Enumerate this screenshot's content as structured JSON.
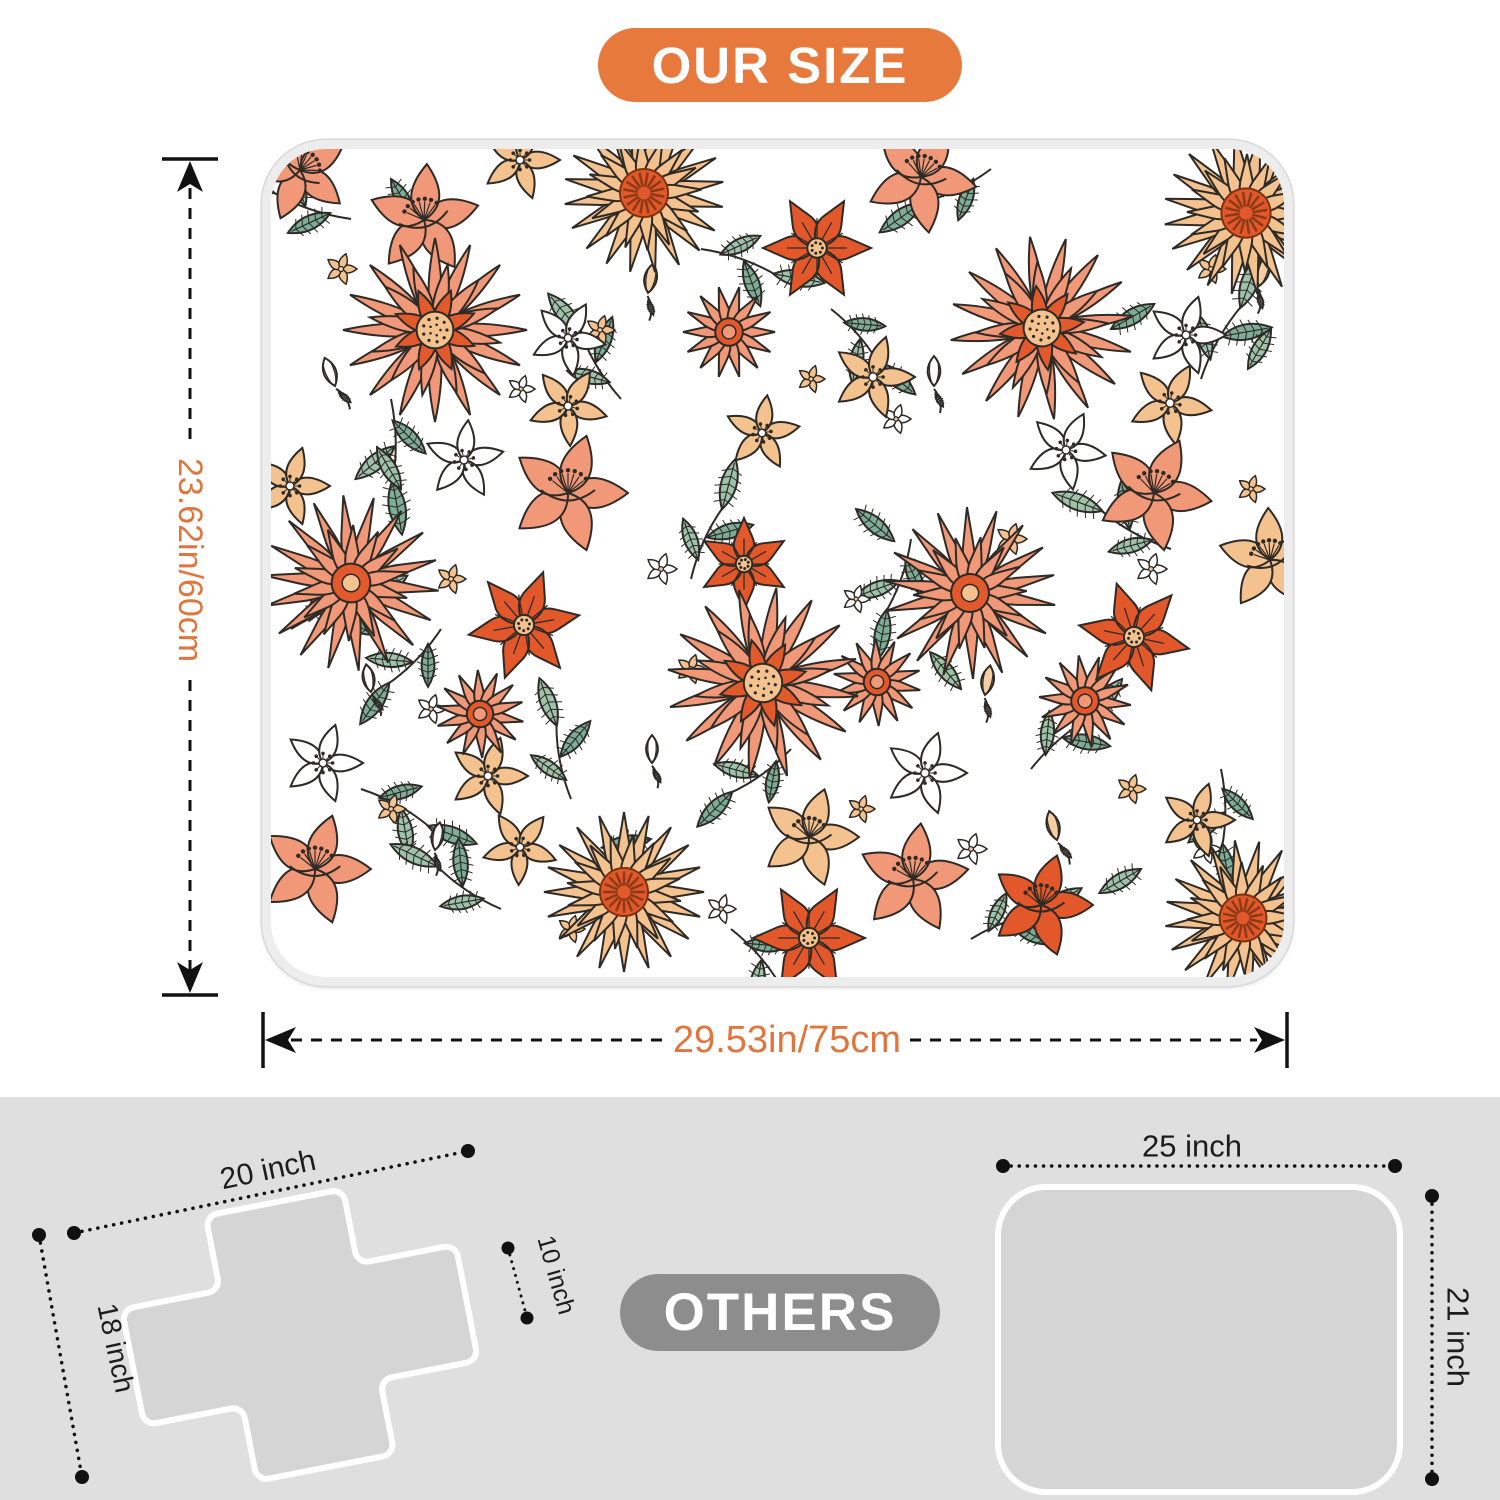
{
  "header": {
    "badge": "OUR SIZE"
  },
  "product_mat": {
    "height_label": "23.62in/60cm",
    "width_label": "29.53in/75cm"
  },
  "others": {
    "badge": "OTHERS",
    "cross_mat": {
      "width_label": "20 inch",
      "side_label": "18 inch",
      "arm_label": "10 inch"
    },
    "rect_mat": {
      "width_label": "25 inch",
      "height_label": "21 inch"
    }
  },
  "colors": {
    "accent": "#E8793C",
    "dim_text": "#DF763E",
    "badge_gray": "#8D8D8D",
    "section_bg": "#DFDFDF",
    "mat_gray": "#D5D5D5",
    "binding": "#EDEDED"
  },
  "floral_palette": {
    "salmon": "#F09878",
    "salmon_dark": "#E25A2B",
    "orange": "#E2582A",
    "peach": "#F4C28F",
    "peach_light": "#F6CEA4",
    "green": "#9EC3AB",
    "green_dark": "#7CAD97",
    "ink": "#2E2A26"
  }
}
